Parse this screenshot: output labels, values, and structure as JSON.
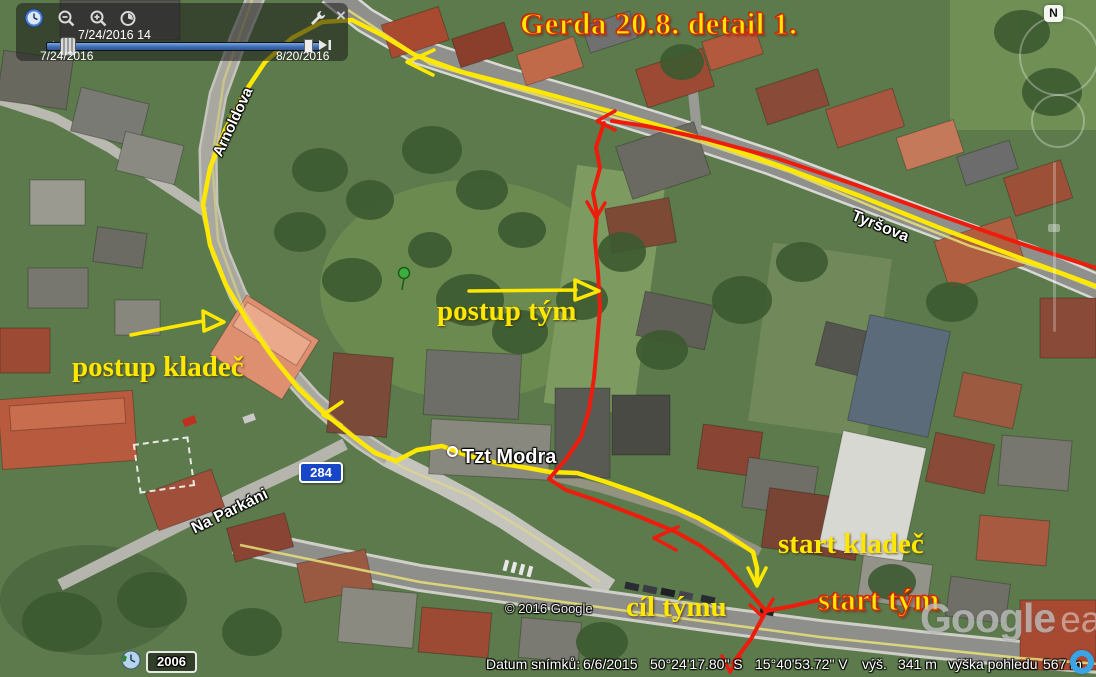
{
  "title": "Gerda 20.8. detail 1.",
  "time_slider": {
    "current": "7/24/2016 14",
    "range_start": "7/24/2016",
    "range_end": "8/20/2016"
  },
  "annotations": {
    "postup_kladec": "postup kladeč",
    "postup_tym": "postup tým",
    "start_kladec": "start kladeč",
    "start_tym": "start tým",
    "cil_tymu": "cíl týmu"
  },
  "streets": {
    "arnoldova": "Arnoldova",
    "tyrsova": "Tyršova",
    "na_parkani": "Na Parkáni",
    "tzt_modra": "Tzt Modra",
    "road_shield": "284"
  },
  "history": {
    "year": "2006"
  },
  "compass": {
    "north": "N"
  },
  "watermark": {
    "copyright": "© 2016 Google",
    "logo_google": "Google",
    "logo_earth": "earth"
  },
  "status_bar": {
    "imagery_date_label": "Datum snímků:",
    "imagery_date": "6/6/2015",
    "latitude": "50°24'17.80\" S",
    "longitude": "15°40'53.72\" V",
    "elevation_label": "výš.",
    "elevation": "341 m",
    "eye_altitude_label": "výška pohledu",
    "eye_altitude": "567 m"
  },
  "colors": {
    "team_route": "#ee1c0c",
    "layer_route": "#ffe800",
    "annotation_yellow": "#ffe800",
    "road_shield_blue": "#1747c8"
  }
}
